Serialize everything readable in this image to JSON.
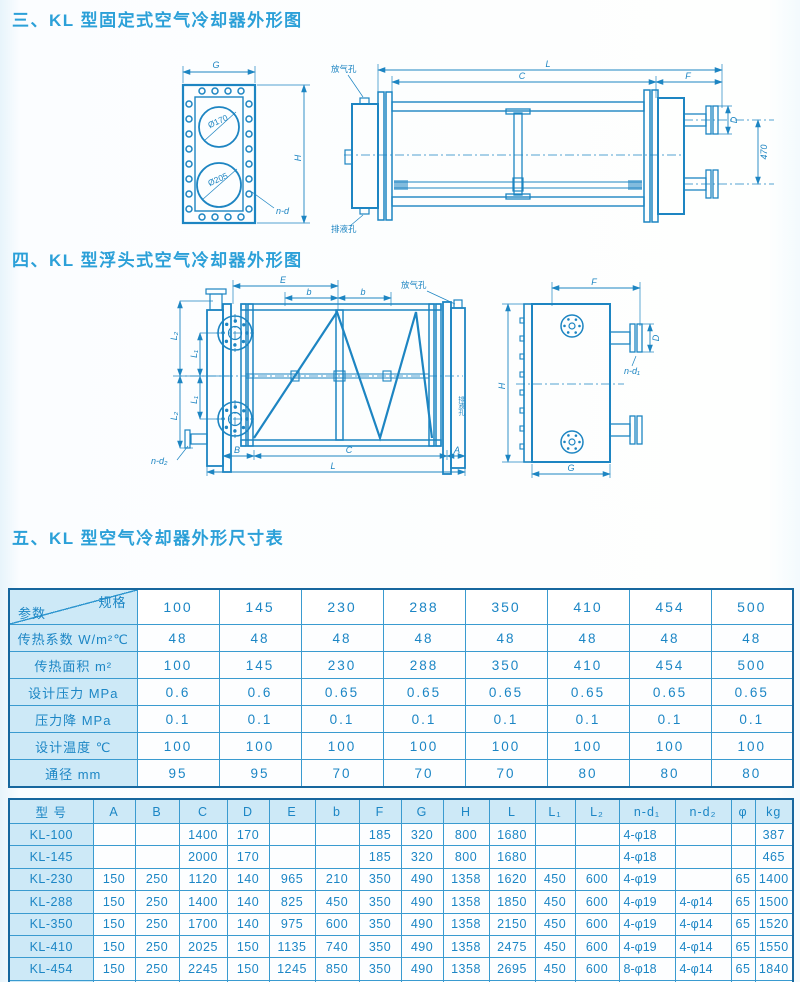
{
  "page": {
    "ink_color": "#1d85c2",
    "title_color": "#2ba0d8",
    "cell_fill": "#cde9f7",
    "border_color": "#17679e"
  },
  "titles": {
    "section3": "三、KL 型固定式空气冷却器外形图",
    "section4": "四、KL 型浮头式空气冷却器外形图",
    "section5": "五、KL 型空气冷却器外形尺寸表"
  },
  "drawings": {
    "fixed_front": {
      "g": "G",
      "h": "H",
      "nd": "n-d",
      "c1": "Ø170",
      "c2": "Ø205"
    },
    "fixed_side": {
      "l": "L",
      "c": "C",
      "f": "F",
      "d": "D",
      "v470": "470",
      "vent": "放气孔",
      "drain": "排液孔"
    },
    "float_front": {
      "e": "E",
      "b": "b",
      "l1": "L₁",
      "l2": "L₂",
      "B": "B",
      "C": "C",
      "A": "A",
      "L": "L",
      "nd2": "n-d₂",
      "vent": "放气孔",
      "drain": "排液孔"
    },
    "float_side": {
      "f": "F",
      "d": "D",
      "nd1": "n-d₁",
      "h": "H",
      "g": "G"
    }
  },
  "spec_table": {
    "corner_top": "规格",
    "corner_bottom": "参数",
    "columns": [
      "100",
      "145",
      "230",
      "288",
      "350",
      "410",
      "454",
      "500"
    ],
    "rows": [
      {
        "label": "传热系数 W/m²℃",
        "values": [
          "48",
          "48",
          "48",
          "48",
          "48",
          "48",
          "48",
          "48"
        ]
      },
      {
        "label": "传热面积 m²",
        "values": [
          "100",
          "145",
          "230",
          "288",
          "350",
          "410",
          "454",
          "500"
        ]
      },
      {
        "label": "设计压力 MPa",
        "values": [
          "0.6",
          "0.6",
          "0.65",
          "0.65",
          "0.65",
          "0.65",
          "0.65",
          "0.65"
        ]
      },
      {
        "label": "压力降 MPa",
        "values": [
          "0.1",
          "0.1",
          "0.1",
          "0.1",
          "0.1",
          "0.1",
          "0.1",
          "0.1"
        ]
      },
      {
        "label": "设计温度 ℃",
        "values": [
          "100",
          "100",
          "100",
          "100",
          "100",
          "100",
          "100",
          "100"
        ]
      },
      {
        "label": "通径 mm",
        "values": [
          "95",
          "95",
          "70",
          "70",
          "70",
          "80",
          "80",
          "80"
        ]
      }
    ]
  },
  "dim_table": {
    "headers": [
      "型  号",
      "A",
      "B",
      "C",
      "D",
      "E",
      "b",
      "F",
      "G",
      "H",
      "L",
      "L₁",
      "L₂",
      "n-d₁",
      "n-d₂",
      "φ",
      "kg"
    ],
    "rows": [
      [
        "KL-100",
        "",
        "",
        "1400",
        "170",
        "",
        "",
        "185",
        "320",
        "800",
        "1680",
        "",
        "",
        "4-φ18",
        "",
        "",
        "387"
      ],
      [
        "KL-145",
        "",
        "",
        "2000",
        "170",
        "",
        "",
        "185",
        "320",
        "800",
        "1680",
        "",
        "",
        "4-φ18",
        "",
        "",
        "465"
      ],
      [
        "KL-230",
        "150",
        "250",
        "1120",
        "140",
        "965",
        "210",
        "350",
        "490",
        "1358",
        "1620",
        "450",
        "600",
        "4-φ19",
        "",
        "65",
        "1400"
      ],
      [
        "KL-288",
        "150",
        "250",
        "1400",
        "140",
        "825",
        "450",
        "350",
        "490",
        "1358",
        "1850",
        "450",
        "600",
        "4-φ19",
        "4-φ14",
        "65",
        "1500"
      ],
      [
        "KL-350",
        "150",
        "250",
        "1700",
        "140",
        "975",
        "600",
        "350",
        "490",
        "1358",
        "2150",
        "450",
        "600",
        "4-φ19",
        "4-φ14",
        "65",
        "1520"
      ],
      [
        "KL-410",
        "150",
        "250",
        "2025",
        "150",
        "1135",
        "740",
        "350",
        "490",
        "1358",
        "2475",
        "450",
        "600",
        "4-φ19",
        "4-φ14",
        "65",
        "1550"
      ],
      [
        "KL-454",
        "150",
        "250",
        "2245",
        "150",
        "1245",
        "850",
        "350",
        "490",
        "1358",
        "2695",
        "450",
        "600",
        "8-φ18",
        "4-φ14",
        "65",
        "1840"
      ],
      [
        "KL-500",
        "150",
        "250",
        "2465",
        "150",
        "1355",
        "960",
        "350",
        "490",
        "1358",
        "2915",
        "450",
        "600",
        "8-φ18",
        "4-φ14",
        "65",
        "2021"
      ]
    ]
  }
}
